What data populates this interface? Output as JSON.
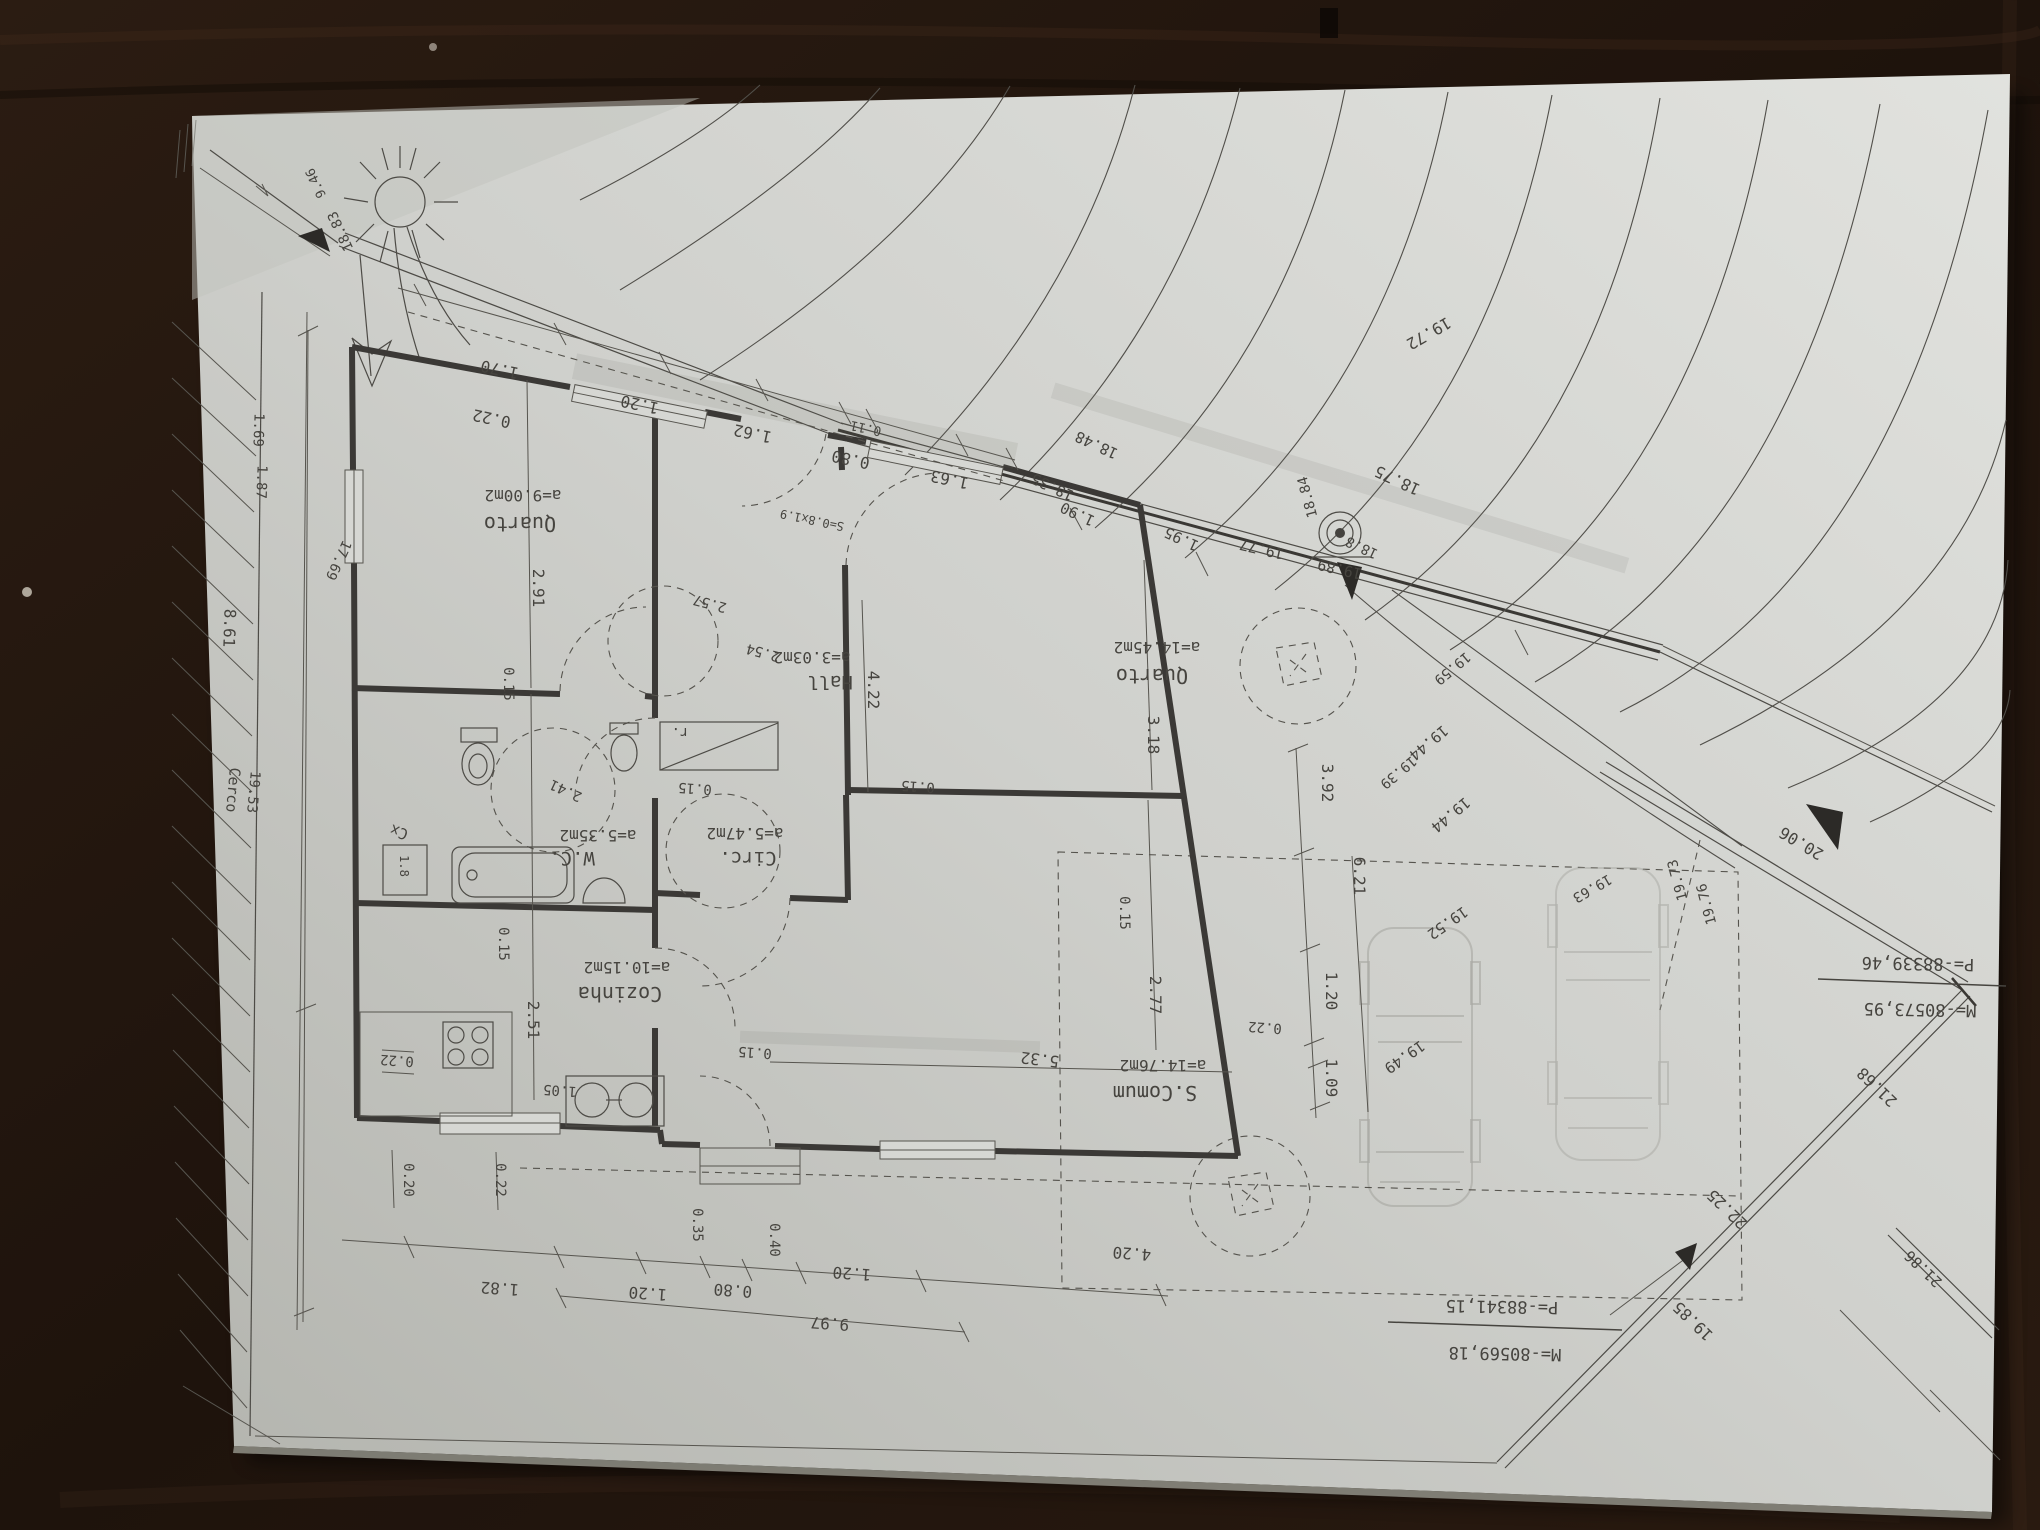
{
  "rooms": [
    {
      "name": "Quarto",
      "area": "a=9.00m2"
    },
    {
      "name": "Hall",
      "area": "a=3.03m2"
    },
    {
      "name": "W.C.",
      "area": "a=5.35m2"
    },
    {
      "name": "Circ.",
      "area": "a=5.47m2"
    },
    {
      "name": "Cozinha",
      "area": "a=10.15m2"
    },
    {
      "name": "S.Comum",
      "area": "a=14.76m2"
    },
    {
      "name": "Quarto",
      "area": "a=14.45m2"
    }
  ],
  "annotations": {
    "closet": "r.",
    "utility_box": "Cx",
    "utility_box_size": "1.8",
    "fence_label": "Cerco",
    "entry_step": "S=0.8x1.9"
  },
  "dims": {
    "top": [
      "0.22",
      "1.70",
      "1.20",
      "1.62",
      "0.80",
      "0.11",
      "1.63"
    ],
    "left": [
      "1.69",
      "1.87",
      "8.61",
      "17.69",
      "19.53"
    ],
    "col_left": [
      "2.91",
      "0.15",
      "2.41",
      "2.51",
      "0.15"
    ],
    "kitchen": [
      "0.22",
      "1.05",
      "0.20",
      "0.22"
    ],
    "mid": [
      "2.57",
      "2.54",
      "0.15",
      "0.15",
      "0.15",
      "4.22",
      "5.32"
    ],
    "col_right": [
      "3.18",
      "2.77",
      "0.15"
    ],
    "right": [
      "3.92",
      "6.21",
      "1.20",
      "1.09",
      "0.22"
    ],
    "bottom": [
      "1.82",
      "1.20",
      "0.80",
      "0.35",
      "0.40",
      "1.20",
      "4.20",
      "9.97"
    ],
    "street": [
      "1.95",
      "1.90"
    ]
  },
  "site": {
    "elev_corner": [
      "9.46",
      "18.83"
    ],
    "elev_street": [
      "18.48",
      "18.35",
      "18.84",
      "18.8",
      "18.75"
    ],
    "elev_field": [
      "19.72",
      "19.77",
      "19.89",
      "19.59",
      "19.44",
      "19.39",
      "19.44",
      "19.52",
      "19.49",
      "19.63",
      "19.73",
      "19.76"
    ],
    "elev_boundary": [
      "20.06",
      "21.68",
      "22.25",
      "21.86",
      "19.85"
    ],
    "coord_a": {
      "m": "M=-80573,95",
      "p": "P=-88339,46"
    },
    "coord_b": {
      "m": "M=-80569,18",
      "p": "P=-88341,15"
    }
  }
}
